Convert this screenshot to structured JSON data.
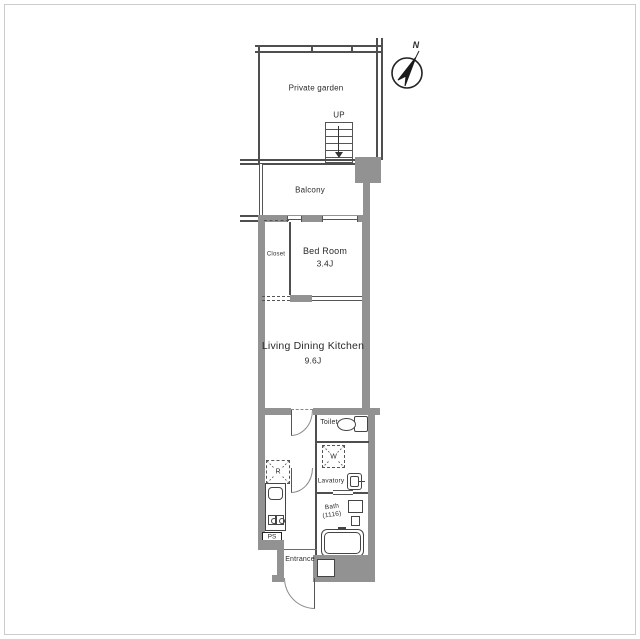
{
  "plan": {
    "compass": {
      "label": "N"
    },
    "garden": {
      "label": "Private garden"
    },
    "stairs": {
      "label": "UP"
    },
    "balcony": {
      "label": "Balcony"
    },
    "bedroom": {
      "label": "Bed Room",
      "size": "3.4J"
    },
    "closet": {
      "label": "Closet"
    },
    "ldk": {
      "label": "Living Dining Kitchen",
      "size": "9.6J"
    },
    "toilet": {
      "label": "Toilet"
    },
    "lavatory": {
      "label": "Lavatory"
    },
    "bath": {
      "label": "Bath",
      "size": "(1116)"
    },
    "entrance": {
      "label": "Entrance"
    },
    "fixtures": {
      "refrigerator": "R",
      "washer": "W",
      "pipe_space": "PS"
    },
    "colors": {
      "wall": "#929292",
      "line": "#4f4f4f"
    }
  }
}
